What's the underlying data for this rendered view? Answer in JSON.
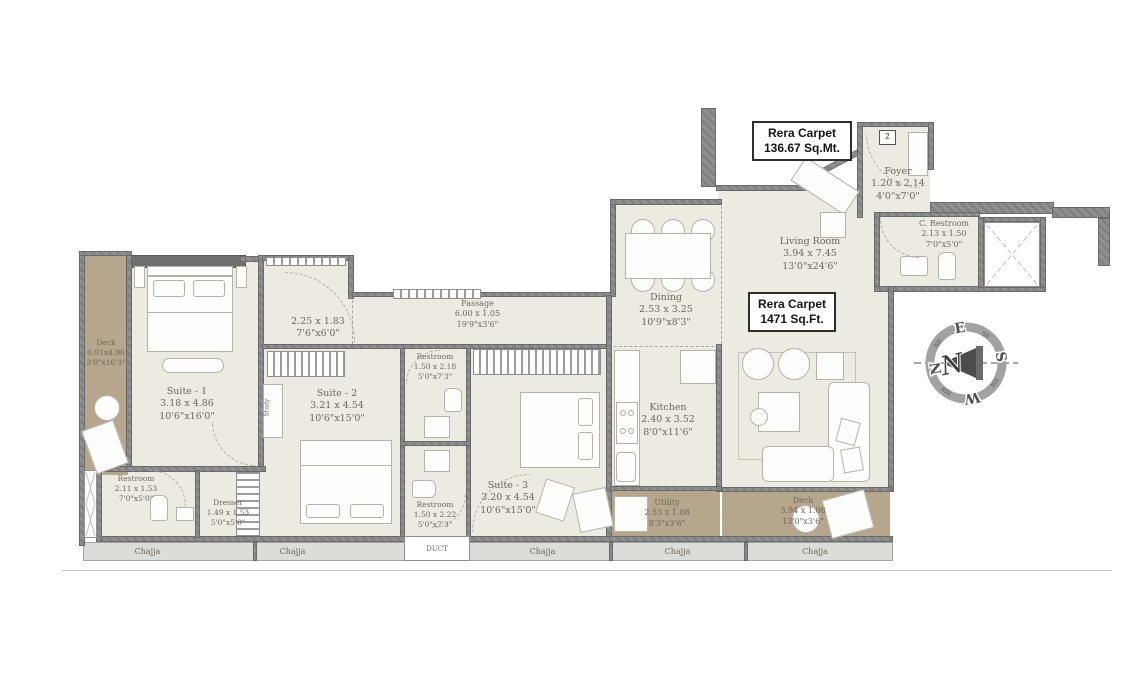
{
  "colors": {
    "floor": "#edeae2",
    "deck": "#b6a68c",
    "wall": "#868686",
    "chajja": "#dcdcd8",
    "label_text": "#6c675d",
    "box_border": "#2e2e2e"
  },
  "area_boxes": {
    "mt": {
      "line1": "Rera Carpet",
      "line2": "136.67 Sq.Mt."
    },
    "ft": {
      "line1": "Rera Carpet",
      "line2": "1471 Sq.Ft."
    }
  },
  "entry_badge": "2",
  "rooms": {
    "foyer": {
      "name": "Foyer",
      "m": "1.20 x 2.14",
      "ft": "4'0\"x7'0\""
    },
    "c_restroom": {
      "name": "C. Restroom",
      "m": "2.13 x 1.50",
      "ft": "7'0\"x5'0\""
    },
    "living": {
      "name": "Living Room",
      "m": "3.94 x 7.45",
      "ft": "13'0\"x24'6\""
    },
    "dining": {
      "name": "Dining",
      "m": "2.53 x 3.25",
      "ft": "10'9\"x8'3\""
    },
    "kitchen": {
      "name": "Kitchen",
      "m": "2.40 x 3.52",
      "ft": "8'0\"x11'6\""
    },
    "passage": {
      "name": "Passage",
      "m": "6.00 x 1.05",
      "ft": "19'9\"x3'6\""
    },
    "lobby": {
      "m": "2.25 x 1.83",
      "ft": "7'6\"x6'0\""
    },
    "suite1": {
      "name": "Suite - 1",
      "m": "3.18 x 4.86",
      "ft": "10'6\"x16'0\""
    },
    "suite2": {
      "name": "Suite - 2",
      "m": "3.21 x 4.54",
      "ft": "10'6\"x15'0\""
    },
    "suite3": {
      "name": "Suite - 3",
      "m": "3.20 x 4.54",
      "ft": "10'6\"x15'0\""
    },
    "restroom2": {
      "name": "Restroom",
      "m": "1.50 x 2.18",
      "ft": "5'0\"x7'3\""
    },
    "restroom3": {
      "name": "Restroom",
      "m": "1.50 x 2.22",
      "ft": "5'0\"x7'3\""
    },
    "restroom1": {
      "name": "Restroom",
      "m": "2.11 x 1.53",
      "ft": "7'0\"x5'0\""
    },
    "dresser": {
      "name": "Dresser",
      "m": "1.49 x 1.53",
      "ft": "5'0\"x5'0\""
    },
    "deck_left": {
      "name": "Deck",
      "m": "0.91x4.96",
      "ft": "3'0\"x16'3\""
    },
    "utility": {
      "name": "Utility",
      "m": "2.53 x 1.08",
      "ft": "8'3\"x3'6\""
    },
    "deck_bottom": {
      "name": "Deck",
      "m": "3.94 x 1.08",
      "ft": "13'0\"x3'6\""
    }
  },
  "annotations": {
    "study": "Study",
    "duct": "DUCT"
  },
  "chajja": {
    "labels": [
      "Chajja",
      "Chajja",
      "Chajja",
      "Chajja",
      "Chajja"
    ]
  },
  "compass": {
    "center": "N",
    "n": "N",
    "e": "E",
    "s": "S",
    "w": "W",
    "ne": "NE",
    "se": "SE",
    "sw": "SW",
    "nw": "NW"
  }
}
